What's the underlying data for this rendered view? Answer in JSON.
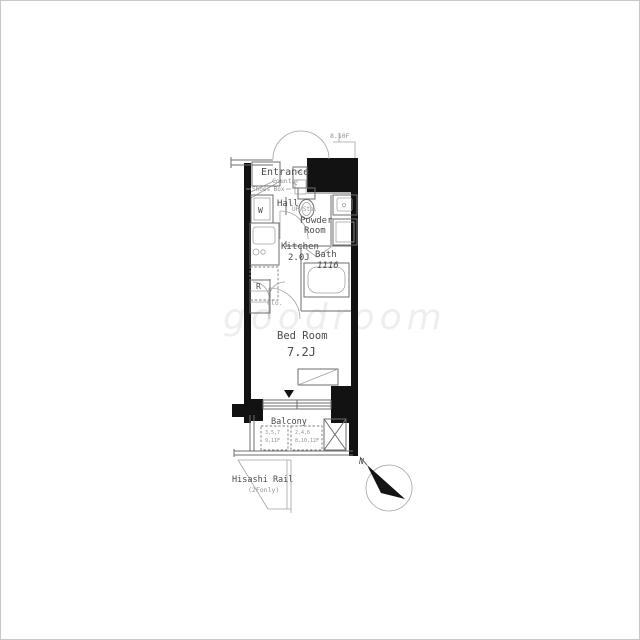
{
  "colors": {
    "wall": "#121212",
    "line": "#6e6e6e",
    "line_light": "#a2a2a2",
    "text": "#4c4c4c",
    "text_light": "#929292",
    "watermark": "#e7e7e7"
  },
  "plan": {
    "floor_note": "8.10F",
    "entrance": {
      "label": "Entrance",
      "counter": "Counter",
      "shoes_box": "Shoes Box",
      "ps": "PS"
    },
    "hall": {
      "label": "Hall",
      "washer": "W",
      "up_storage": "UP/Sto."
    },
    "powder_room": {
      "line1": "Powder",
      "line2": "Room"
    },
    "kitchen": {
      "label": "Kitchen",
      "size": "2.0J",
      "fridge": "R",
      "closet": "Clo."
    },
    "bath": {
      "label": "Bath",
      "size": "1116"
    },
    "bedroom": {
      "label": "Bed Room",
      "size": "7.2J"
    },
    "balcony": {
      "label": "Balcony",
      "window_note_left": {
        "line1": "3,5,7",
        "line2": "9,11F"
      },
      "window_note_right": {
        "line1": "2,4,6",
        "line2": "8,10,12F"
      }
    },
    "hisashi": {
      "label": "Hisashi Rail",
      "sub": "(2Fonly)"
    },
    "compass": {
      "north": "N"
    },
    "watermark": "goodroom"
  }
}
